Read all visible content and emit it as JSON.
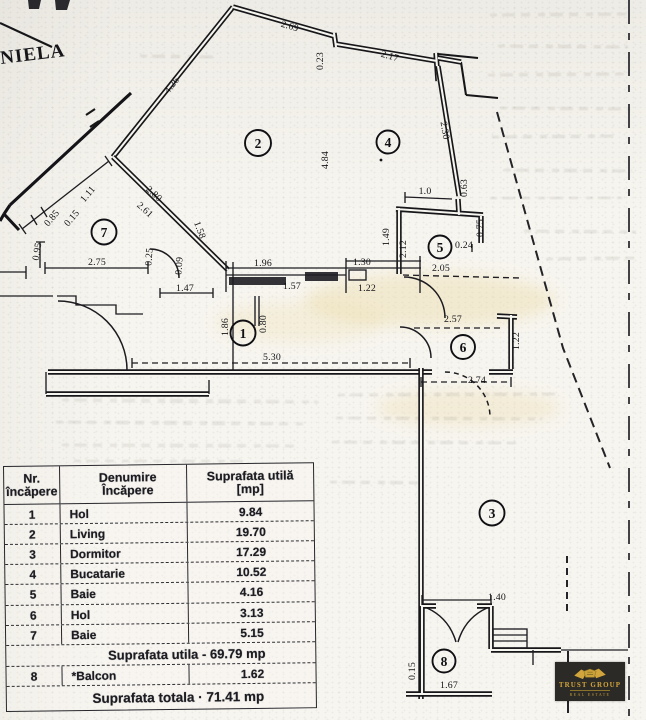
{
  "stamps": {
    "corner_text": "NIELA",
    "trust_logo": {
      "name": "TRUST GROUP",
      "tagline": "REAL ESTATE",
      "bg_color": "#2b2a26",
      "gold_color": "#d2a43c",
      "icon": "handshake-icon"
    }
  },
  "plan": {
    "room_numbers": [
      "1",
      "2",
      "3",
      "4",
      "5",
      "6",
      "7",
      "8"
    ],
    "dims": [
      "4.26",
      "2.69",
      "0.23",
      "2.17",
      "4.84",
      "2.30",
      "1.0",
      "0.63",
      "0.75",
      "0.24",
      "2.05",
      "2.12",
      "1.49",
      "2.57",
      "1.22",
      "2.74",
      "1.96",
      "1.30",
      "1.57",
      "1.22",
      "1.47",
      "1.86",
      "0.80",
      "5.30",
      "2.75",
      "0.95",
      "0.25",
      "0.09",
      "1.58",
      "2.80",
      "2.61",
      "1.11",
      "0.85",
      "0.15",
      "1.40",
      "1.67",
      "0.15"
    ]
  },
  "table": {
    "header": {
      "col1_line1": "Nr.",
      "col1_line2": "încăpere",
      "col2_line1": "Denumire",
      "col2_line2": "Încăpere",
      "col3_line1": "Suprafata utilă",
      "col3_line2": "[mp]"
    },
    "rows": [
      {
        "nr": "1",
        "name": "Hol",
        "area": "9.84"
      },
      {
        "nr": "2",
        "name": "Living",
        "area": "19.70"
      },
      {
        "nr": "3",
        "name": "Dormitor",
        "area": "17.29"
      },
      {
        "nr": "4",
        "name": "Bucatarie",
        "area": "10.52"
      },
      {
        "nr": "5",
        "name": "Baie",
        "area": "4.16"
      },
      {
        "nr": "6",
        "name": "Hol",
        "area": "3.13"
      },
      {
        "nr": "7",
        "name": "Baie",
        "area": "5.15"
      }
    ],
    "subtotal_label": "Suprafata utila - 69.79 mp",
    "balcony_row": {
      "nr": "8",
      "name": "*Balcon",
      "area": "1.62"
    },
    "total_label": "Suprafata totala · 71.41 mp"
  }
}
